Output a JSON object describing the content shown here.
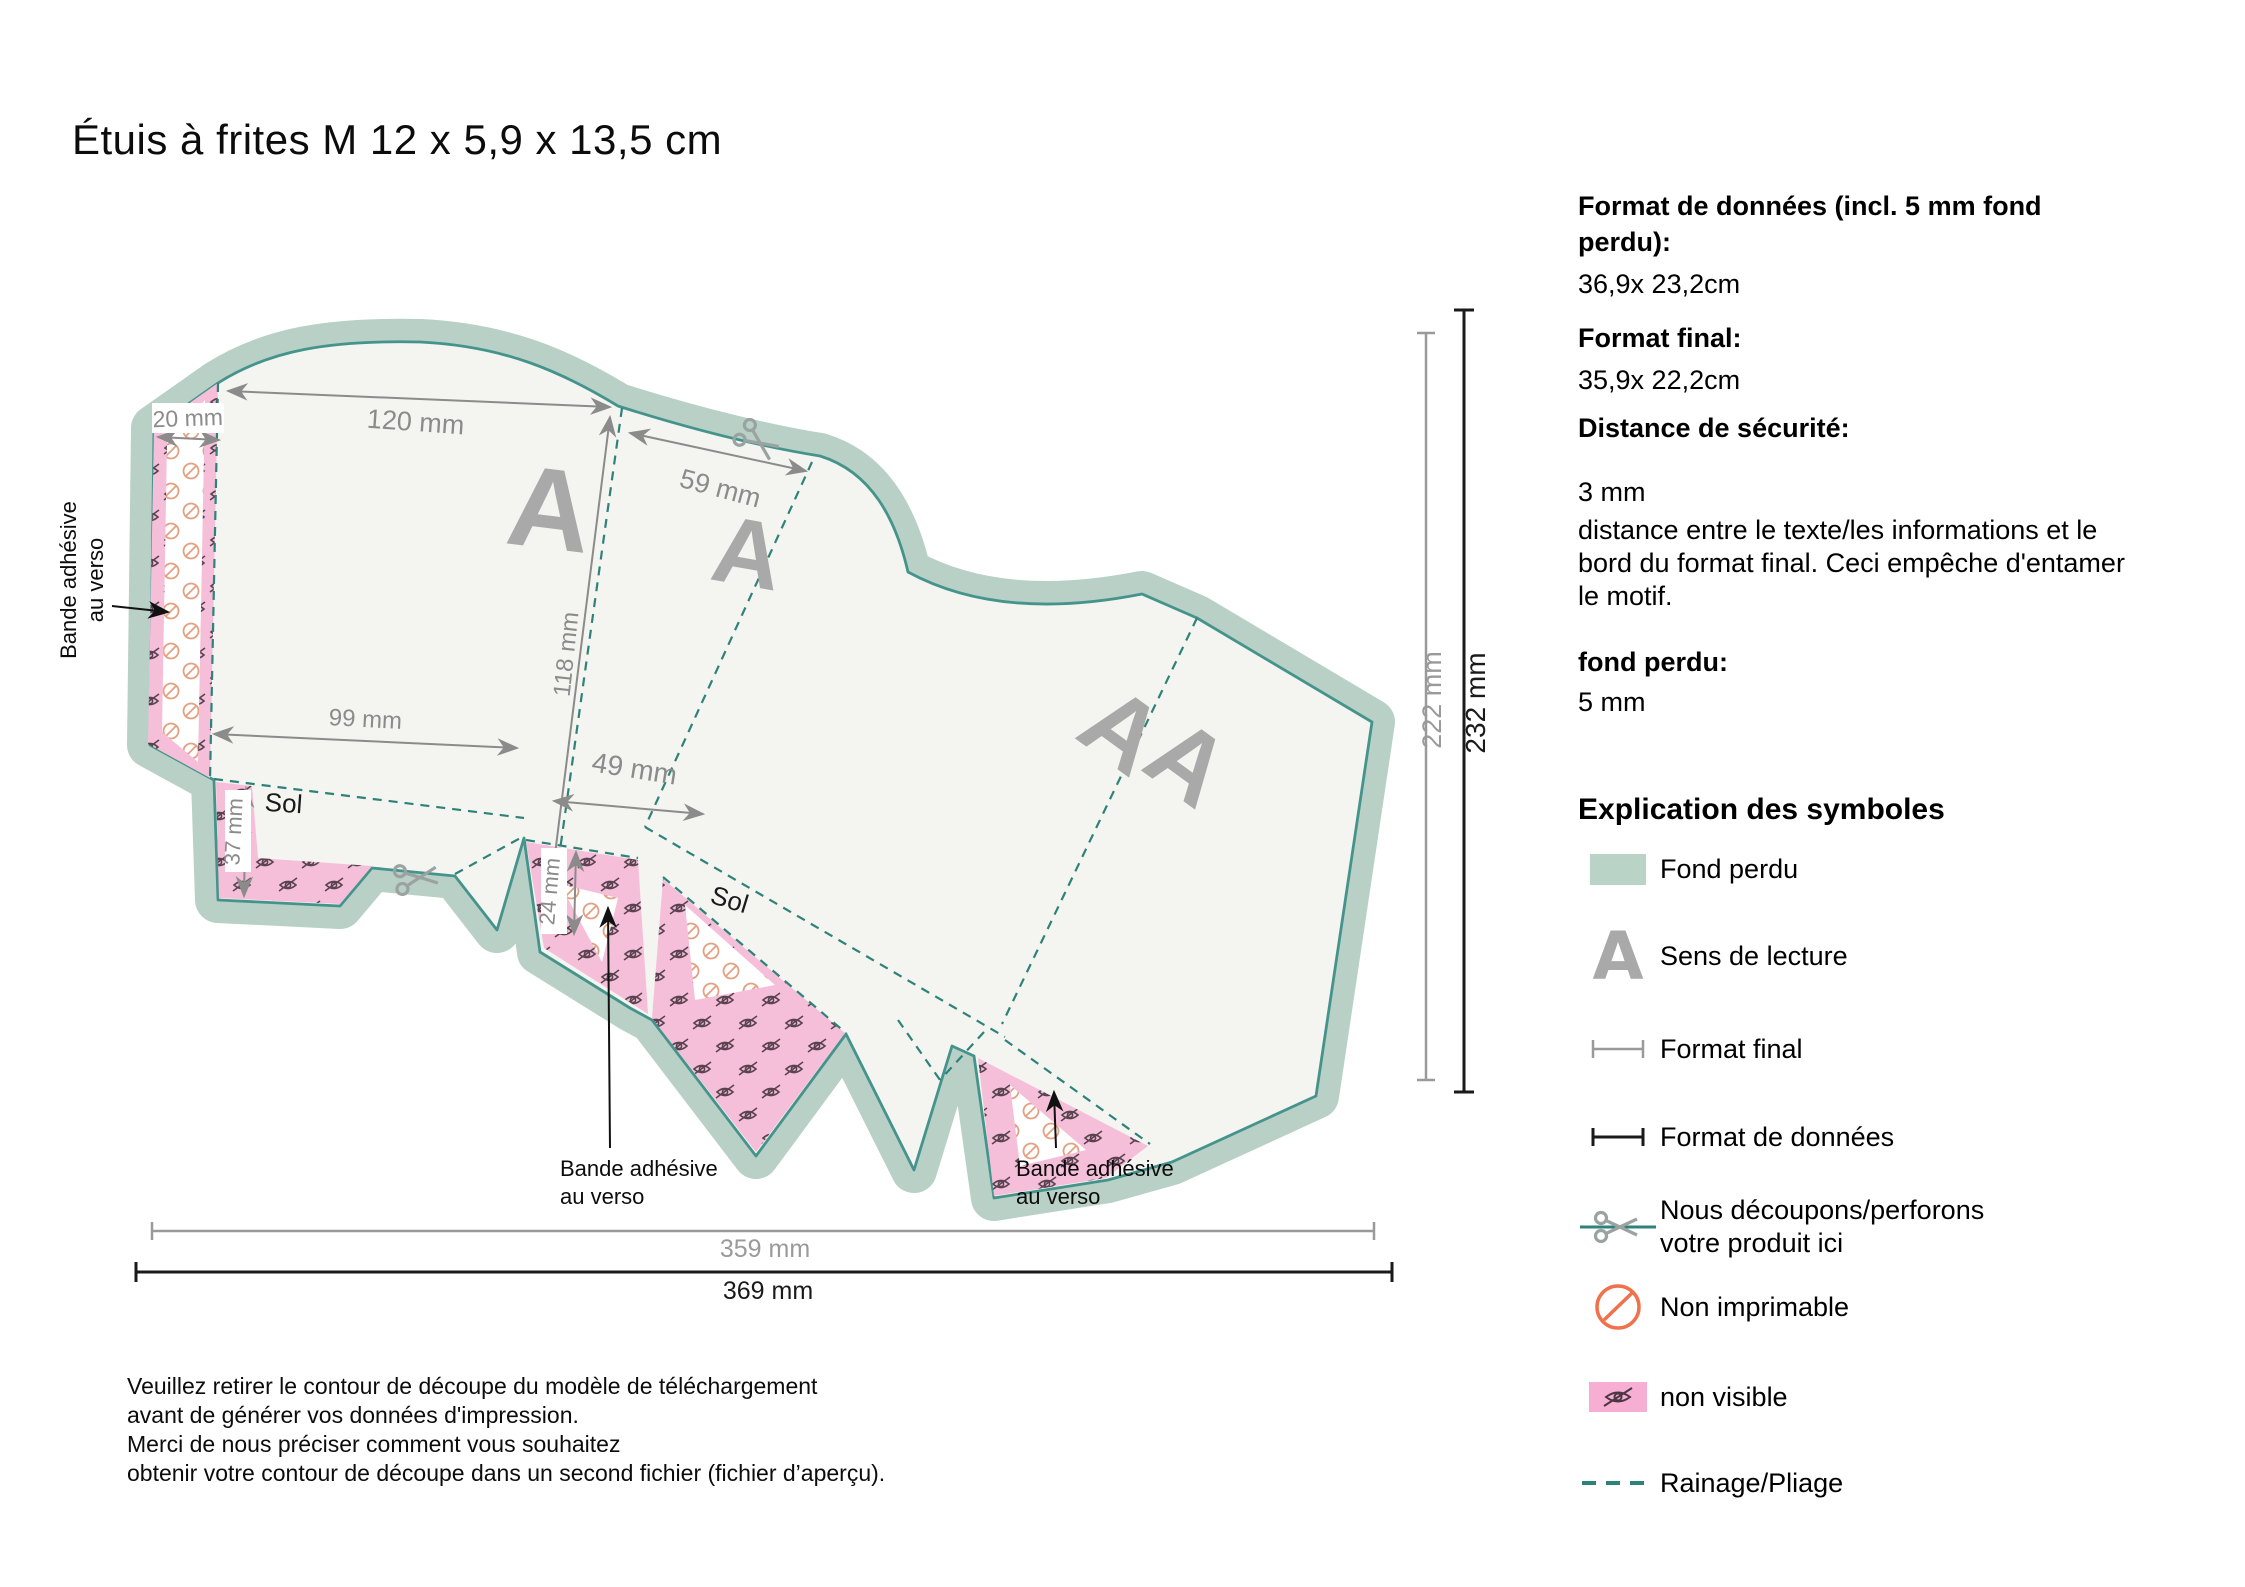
{
  "title": "Étuis à frites M 12 x 5,9 x 13,5 cm",
  "info": {
    "data_format_label": "Format de données (incl. 5 mm fond perdu):",
    "data_format_value": "36,9x 23,2cm",
    "final_format_label": "Format final:",
    "final_format_value": "35,9x 22,2cm",
    "safety_label": "Distance de sécurité:",
    "safety_value": "3 mm",
    "safety_desc": "distance entre le texte/les informations et le bord du format final. Ceci empêche d'entamer le motif.",
    "bleed_label": "fond perdu:",
    "bleed_value": "5 mm"
  },
  "legend": {
    "heading": "Explication des symboles",
    "items": [
      {
        "id": "fond-perdu",
        "label": "Fond perdu"
      },
      {
        "id": "sens-de-lecture",
        "label": "Sens de lecture",
        "glyph": "A"
      },
      {
        "id": "format-final",
        "label": "Format final"
      },
      {
        "id": "format-de-donnees",
        "label": "Format de données"
      },
      {
        "id": "decoupe",
        "label": "Nous découpons/perforons",
        "label2": "votre produit ici"
      },
      {
        "id": "non-imprimable",
        "label": "Non imprimable"
      },
      {
        "id": "non-visible",
        "label": "non visible"
      },
      {
        "id": "rainage-pliage",
        "label": "Rainage/Pliage"
      }
    ]
  },
  "dims": {
    "d20": "20 mm",
    "d120": "120 mm",
    "d59": "59 mm",
    "d118": "118 mm",
    "d99": "99 mm",
    "d49": "49 mm",
    "d37": "37 mm",
    "d24": "24 mm",
    "d222": "222 mm",
    "d232": "232 mm",
    "d359": "359 mm",
    "d369": "369 mm"
  },
  "diagram": {
    "adhesive_1": "Bande adhésive",
    "adhesive_2": "au verso",
    "sol": "Sol",
    "reading_a": "A"
  },
  "note": {
    "line1": "Veuillez retirer le contour de découpe du modèle de téléchargement",
    "line2": "avant de générer vos données d'impression.",
    "line3": "Merci de nous préciser comment vous souhaitez",
    "line4": "obtenir votre contour de découpe dans un second fichier (fichier d’aperçu)."
  },
  "colors": {
    "bleed_band": "#b9d0c6",
    "cut_line": "#45948c",
    "fold_line": "#2e8279",
    "paper": "#f4f4f0",
    "pink": "#f6bfd9",
    "dim_gray": "#8b8b8b",
    "reading_gray": "#a9a9a9",
    "non_printable_orange": "#f0714a"
  }
}
